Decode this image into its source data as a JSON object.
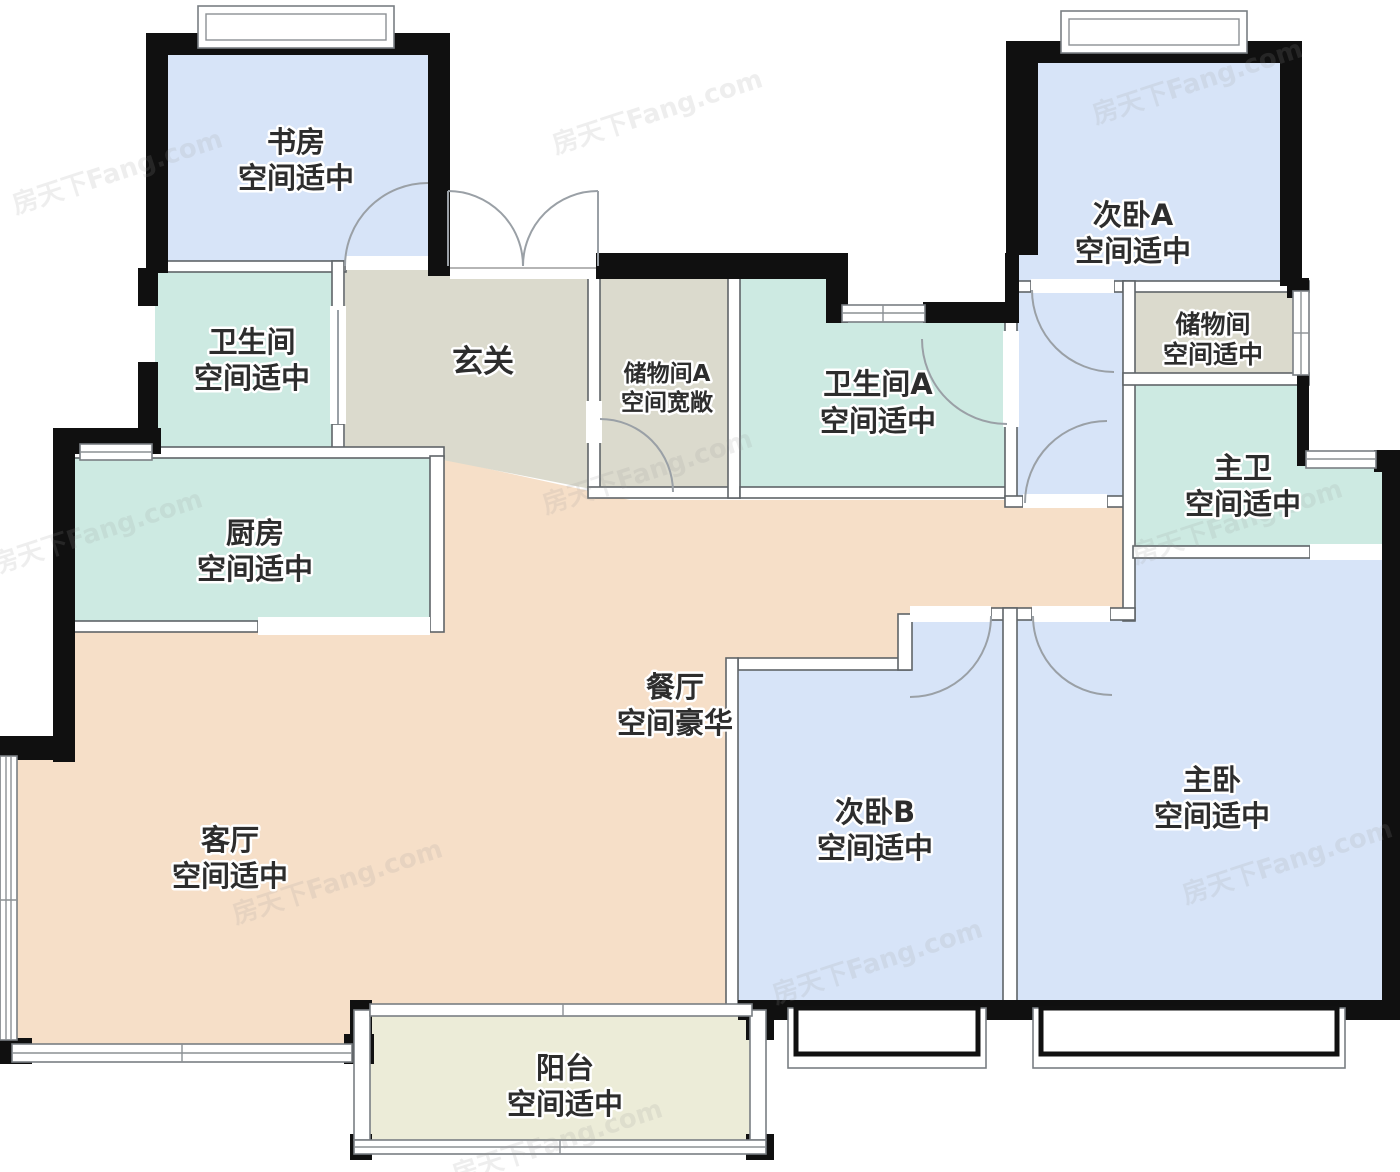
{
  "watermark": "房天下Fang.com",
  "colors": {
    "bedroom_blue": "#d7e4f8",
    "bath_teal": "#cdeae2",
    "foyer_gray": "#dbdacd",
    "living_peach": "#f6dfc8",
    "balcony_cream": "#ececd8",
    "wall_black": "#101010"
  },
  "rooms": [
    {
      "id": "study",
      "name": "书房",
      "note": "空间适中"
    },
    {
      "id": "bathroom",
      "name": "卫生间",
      "note": "空间适中"
    },
    {
      "id": "foyer",
      "name": "玄关",
      "note": ""
    },
    {
      "id": "storage-a",
      "name": "储物间A",
      "note": "空间宽敞"
    },
    {
      "id": "bathroom-a",
      "name": "卫生间A",
      "note": "空间适中"
    },
    {
      "id": "bedroom-a",
      "name": "次卧A",
      "note": "空间适中"
    },
    {
      "id": "storage",
      "name": "储物间",
      "note": "空间适中"
    },
    {
      "id": "master-bath",
      "name": "主卫",
      "note": "空间适中"
    },
    {
      "id": "kitchen",
      "name": "厨房",
      "note": "空间适中"
    },
    {
      "id": "dining",
      "name": "餐厅",
      "note": "空间豪华"
    },
    {
      "id": "living",
      "name": "客厅",
      "note": "空间适中"
    },
    {
      "id": "bedroom-b",
      "name": "次卧B",
      "note": "空间适中"
    },
    {
      "id": "master-bedroom",
      "name": "主卧",
      "note": "空间适中"
    },
    {
      "id": "balcony",
      "name": "阳台",
      "note": "空间适中"
    }
  ]
}
